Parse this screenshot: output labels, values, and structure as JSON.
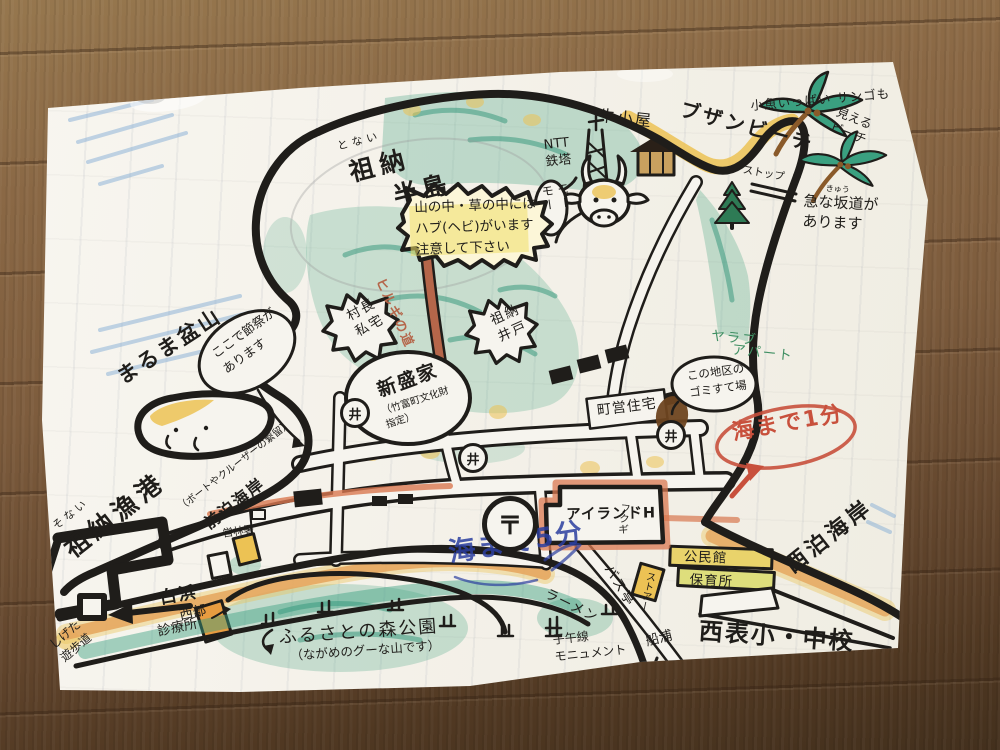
{
  "colors": {
    "ink": "#1f1d1a",
    "paper": "#f4f1e9",
    "wood": "#7d5c3d",
    "vegetation_teal": "#4aa585",
    "beach_sand": "#e5a55c",
    "highlight_yellow": "#ecc254",
    "red_marker": "#c8503c",
    "road_red": "#d97850",
    "blue_pen": "#2b3fa0",
    "sea_blue": "#85aed6",
    "green_pencil": "#3f8f63",
    "trail_red": "#b5664a"
  },
  "symbols": {
    "well": "井",
    "post_office": "〒"
  },
  "labels": {
    "buzan_beach": "ブザンビーチ",
    "small_fish_note": "小魚いっぱい サンゴも",
    "small_fish_note2": "見える\nビーチ",
    "steep_slope_furigana": "きゅう",
    "steep_slope": "急な坂道が\nあります",
    "stop": "ストップ",
    "sonai_peninsula_furigana": "とない",
    "sonai_peninsula_1": "祖納",
    "sonai_peninsula_2": "半島",
    "ntt_tower": "NTT\n鉄塔",
    "cow_shed": "牛小屋",
    "moo": "モー\nモー",
    "habu_warning": "山の中・草の中には\nハブ(ヘビ)がいます\n注意して下さい",
    "hirugi_road": "ヒルギの道",
    "village_head_house": "村長\n私宅",
    "sonai_well": "祖納\n井戸",
    "festival_note": "ここで節祭が\nあります",
    "maruma_bonsan": "まるま盆山",
    "sonai_port_furigana": "そない",
    "sonai_port": "祖納漁港",
    "maedomari_note": "（ボートやクルーザーの繋留）",
    "maedomari_beach": "前泊海岸",
    "shirahama": "白浜",
    "clinic_1": "西部",
    "clinic_2": "診療所",
    "shigeta_walk": "しげた\n遊歩道",
    "furusato_park": "ふるさとの森公園",
    "furusato_park_note": "（ながめのグーな山です）",
    "forestry_office": "営林署",
    "island_hotel": "アイランドH",
    "fukugi": "フクギ",
    "sea_5min_scribble": "海まで5分",
    "sea_1min": "海まで1分",
    "garbage_note": "この地区の\nゴミすて場",
    "yarabu_1": "ヤラブ",
    "yarabu_2": "アパート",
    "town_housing": "町営住宅",
    "shinsei_house": "新盛家",
    "shinsei_house_note": "（竹富町文化財\n指定）",
    "community_hall": "公民館",
    "nursery": "保育所",
    "bus_stop": "バス亭",
    "store": "ストアー",
    "ramen": "ラーメン",
    "school": "西表小・中校",
    "funaura": "船浦",
    "meridian_monument": "子午線\nモニュメント",
    "nishidomari_beach": "西泊海岸"
  }
}
